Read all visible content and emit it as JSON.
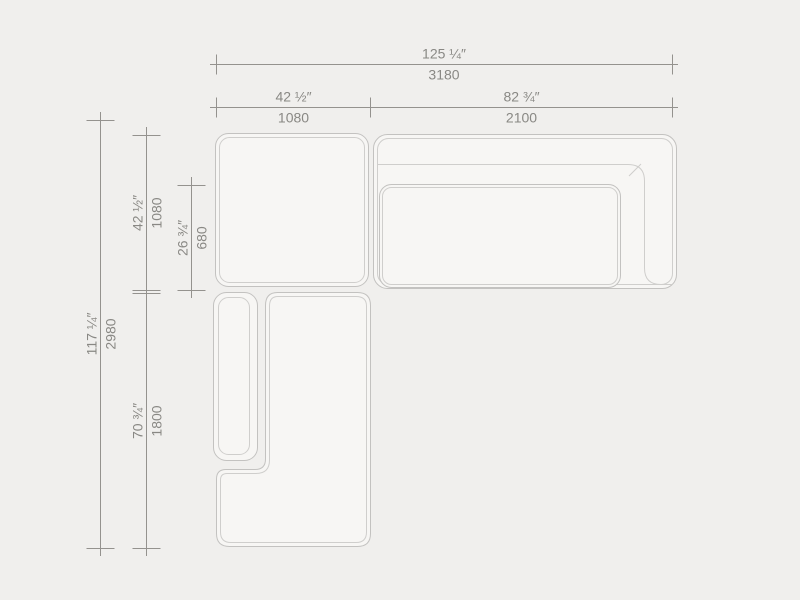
{
  "drawing": {
    "type": "sectional-sofa-top-view-dimension-drawing",
    "modules": [
      "pouf-module",
      "sofa-module",
      "chaise-module"
    ]
  },
  "colors": {
    "background": "#f0efed",
    "module_fill": "#f7f6f4",
    "module_stroke": "#c3c2c0",
    "inner_seam_stroke": "#cfcecc",
    "dimension_line": "#94928e",
    "dimension_text": "#898884"
  },
  "dimensions": {
    "overall_width": {
      "inches": "125 ¼″",
      "mm": "3180"
    },
    "pouf_width": {
      "inches": "42 ½″",
      "mm": "1080"
    },
    "sofa_width": {
      "inches": "82 ¾″",
      "mm": "2100"
    },
    "overall_depth": {
      "inches": "117 ¼″",
      "mm": "2980"
    },
    "pouf_depth": {
      "inches": "42 ½″",
      "mm": "1080"
    },
    "seat_depth": {
      "inches": "26 ¾″",
      "mm": "680"
    },
    "chaise_length": {
      "inches": "70 ¾″",
      "mm": "1800"
    }
  }
}
